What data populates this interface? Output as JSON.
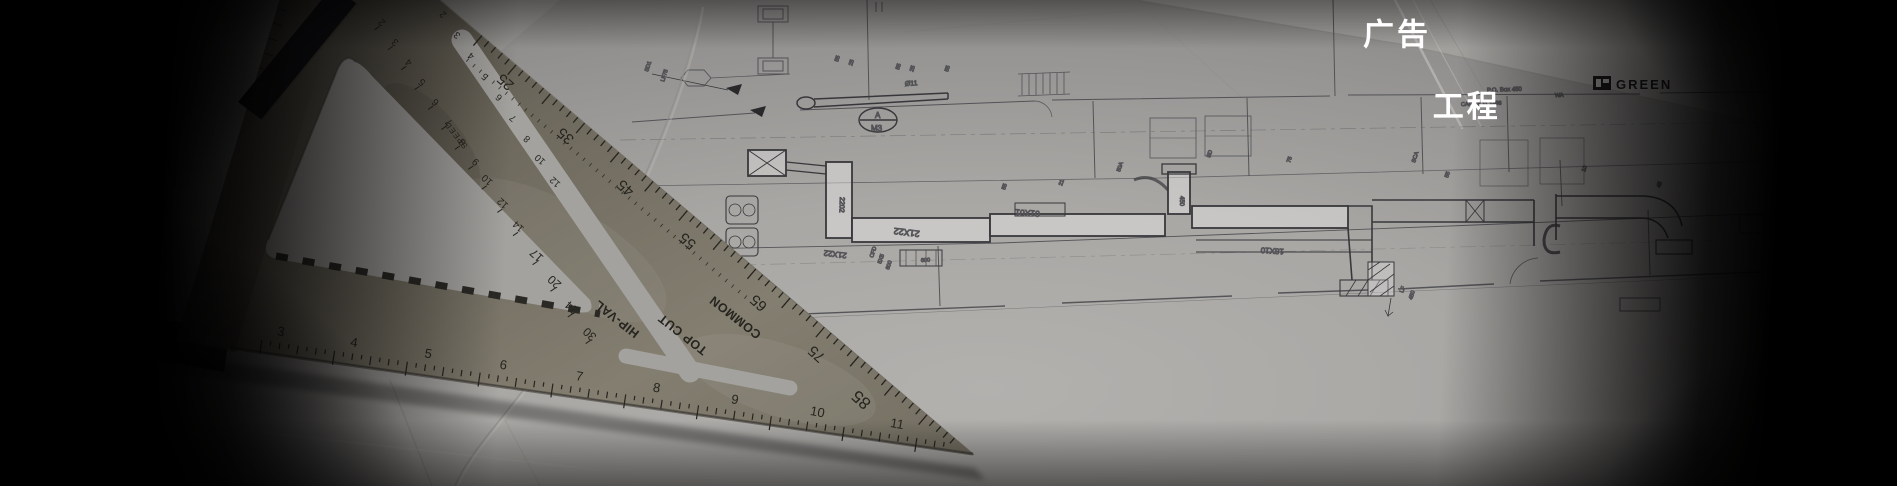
{
  "overlay": {
    "line1": "广告",
    "line2": "工程",
    "color": "#ffffff"
  },
  "blueprint": {
    "logo_text": "GREEN",
    "prints": [
      {
        "t": "P.O. Box 450",
        "x": 1487,
        "y": 92,
        "s": 6
      },
      {
        "t": "WA",
        "x": 1555,
        "y": 97,
        "s": 5.5
      },
      {
        "t": "CAPS 8 11 1398",
        "x": 1461,
        "y": 106,
        "s": 5.5
      }
    ],
    "tag": {
      "top": "A",
      "bottom": "M3"
    },
    "duct_labels": [
      {
        "t": "21X22",
        "x": 920,
        "y": 231,
        "r": 187,
        "s": 9
      },
      {
        "t": "21X22",
        "x": 847,
        "y": 253,
        "r": 187,
        "s": 8
      },
      {
        "t": "01X01",
        "x": 1040,
        "y": 211,
        "r": 184,
        "s": 8.5
      },
      {
        "t": "18X10",
        "x": 1284,
        "y": 249,
        "r": 184,
        "s": 8
      },
      {
        "t": "2202",
        "x": 840,
        "y": 197,
        "r": 92,
        "s": 7
      },
      {
        "t": "Ø11",
        "x": 905,
        "y": 86,
        "r": -4,
        "s": 7
      },
      {
        "t": "450",
        "x": 1180,
        "y": 196,
        "r": 90,
        "s": 6
      },
      {
        "t": "600",
        "x": 921,
        "y": 262,
        "r": -3,
        "s": 5.5
      }
    ],
    "micro_labels": [
      {
        "t": "55",
        "x": 838,
        "y": 62
      },
      {
        "t": "25",
        "x": 852,
        "y": 66
      },
      {
        "t": "55",
        "x": 899,
        "y": 70
      },
      {
        "t": "25",
        "x": 913,
        "y": 72
      },
      {
        "t": "55",
        "x": 948,
        "y": 72
      },
      {
        "t": "SD1",
        "x": 648,
        "y": 72
      },
      {
        "t": "LF75",
        "x": 664,
        "y": 82
      },
      {
        "t": "50A",
        "x": 1120,
        "y": 172
      },
      {
        "t": "55",
        "x": 1005,
        "y": 190
      },
      {
        "t": "21",
        "x": 1062,
        "y": 186
      },
      {
        "t": "SD",
        "x": 1210,
        "y": 158
      },
      {
        "t": "75",
        "x": 1290,
        "y": 163
      },
      {
        "t": "SCA",
        "x": 1415,
        "y": 163
      },
      {
        "t": "55",
        "x": 1448,
        "y": 178
      },
      {
        "t": "10",
        "x": 1585,
        "y": 172
      },
      {
        "t": "45",
        "x": 1660,
        "y": 188
      },
      {
        "t": "LF",
        "x": 1403,
        "y": 293
      },
      {
        "t": "450",
        "x": 1412,
        "y": 300
      },
      {
        "t": "CFD",
        "x": 873,
        "y": 258
      },
      {
        "t": "5X5",
        "x": 881,
        "y": 264
      },
      {
        "t": "600",
        "x": 889,
        "y": 270
      }
    ]
  },
  "speed_square": {
    "brand": "SPEED",
    "rafter_labels": [
      "HIP-VAL",
      "TOP CUT",
      "COMMON"
    ],
    "degree_scale": [
      25,
      35,
      45,
      55,
      65,
      75,
      85
    ],
    "common_scale": [
      2,
      3,
      4,
      5,
      6,
      7,
      8,
      9,
      10,
      12,
      14,
      17,
      20,
      24,
      30
    ],
    "hyp_inch_scale": [
      2,
      3,
      4,
      5,
      6,
      7,
      8,
      10,
      12
    ],
    "bottom_inch_scale": [
      3,
      4,
      5,
      6,
      7,
      8,
      9,
      10,
      11
    ]
  },
  "palette": {
    "paper": "#aba9a6",
    "paper_shadow": "#a3a19e",
    "metal": "#6f6a5e",
    "metal_dark": "#46433c",
    "ink": "#26241f",
    "plan_line": "#4b4b50",
    "vignette": "#000000",
    "title_color": "#ffffff",
    "logo_ink": "#1c1c1c"
  }
}
